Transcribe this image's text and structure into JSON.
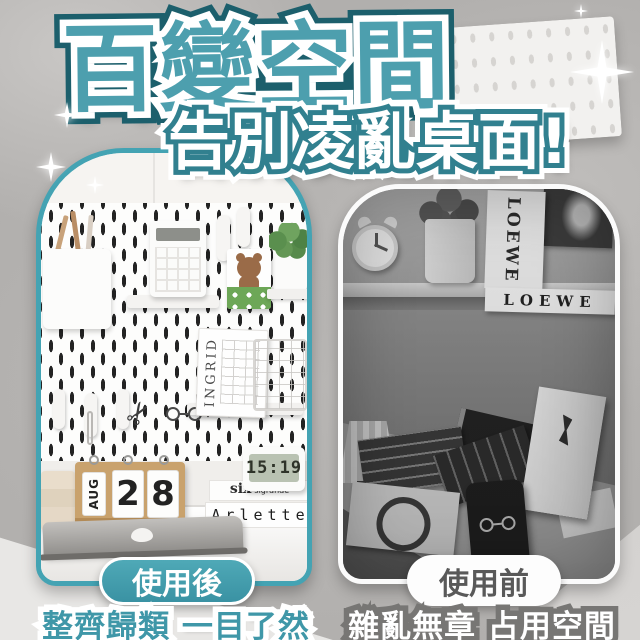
{
  "page": {
    "type": "product-ad-banner",
    "language": "zh-TW"
  },
  "colors": {
    "accent_teal": "#4d9fae",
    "accent_teal_dark": "#1c5f6c",
    "panel_border_teal": "#44a3b3",
    "badge_after_bg": "#41a0b0",
    "badge_before_text": "#595959",
    "background_gray": "#b1afad"
  },
  "header": {
    "title": "百變空間",
    "subtitle": "告別凌亂桌面!"
  },
  "after": {
    "badge": "使用後",
    "caption": "整齊歸類 一目了然",
    "photo": {
      "book_spine": "INGRID",
      "calendar_month": "AUG",
      "calendar_day_tens": "2",
      "calendar_day_ones": "8",
      "clock_time": "15:19",
      "brand_main": "six",
      "brand_sub": "sigrande",
      "book_title": "Arlette"
    }
  },
  "before": {
    "badge": "使用前",
    "caption": "雜亂無章 占用空間",
    "photo": {
      "standing_book": "LOEWE",
      "flat_book": "LOEWE"
    }
  },
  "icons": {
    "sparkle": "four-point-star",
    "scissors": "✂"
  }
}
